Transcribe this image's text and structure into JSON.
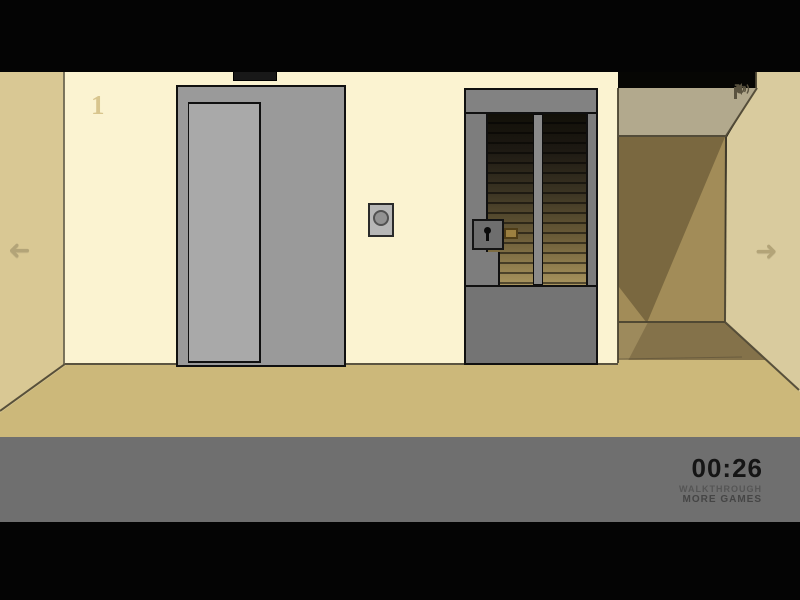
{
  "hud": {
    "floor_number": "1",
    "timer": "00:26",
    "walkthrough": "WALKTHROUGH",
    "more_games": "MORE GAMES",
    "icons": {
      "pause": "pause-icon",
      "restart": "restart-icon",
      "restart_glyph": "↻",
      "sound": "sound-icon"
    }
  },
  "nav": {
    "arrow_glyph": "➜",
    "left": "go-left",
    "right": "go-right"
  },
  "scene": {
    "objects": [
      "elevator-doors",
      "elevator-indicator-panel",
      "elevator-call-button",
      "barred-gate",
      "gate-lock",
      "gate-latch",
      "stairwell-behind-gate",
      "corridor-opening"
    ]
  },
  "palette": {
    "wall_cream": "#fbf3d1",
    "wall_side_left": "#d9c894",
    "floor_tan": "#ccb87a",
    "corridor_ceiling": "#b2a98d",
    "corridor_wall_dark": "#7a6840",
    "corridor_wall_light": "#a28c58",
    "corridor_floor": "#84724a",
    "wall_right": "#d9cb9e",
    "foreground_gray": "#6f6f6f",
    "elevator_gray": "#9a9a9a",
    "door_panel_gray": "#a9a9a9",
    "gate_gray": "#7d7d7d",
    "latch_brass": "#9c8040",
    "timer_text": "#151515"
  }
}
